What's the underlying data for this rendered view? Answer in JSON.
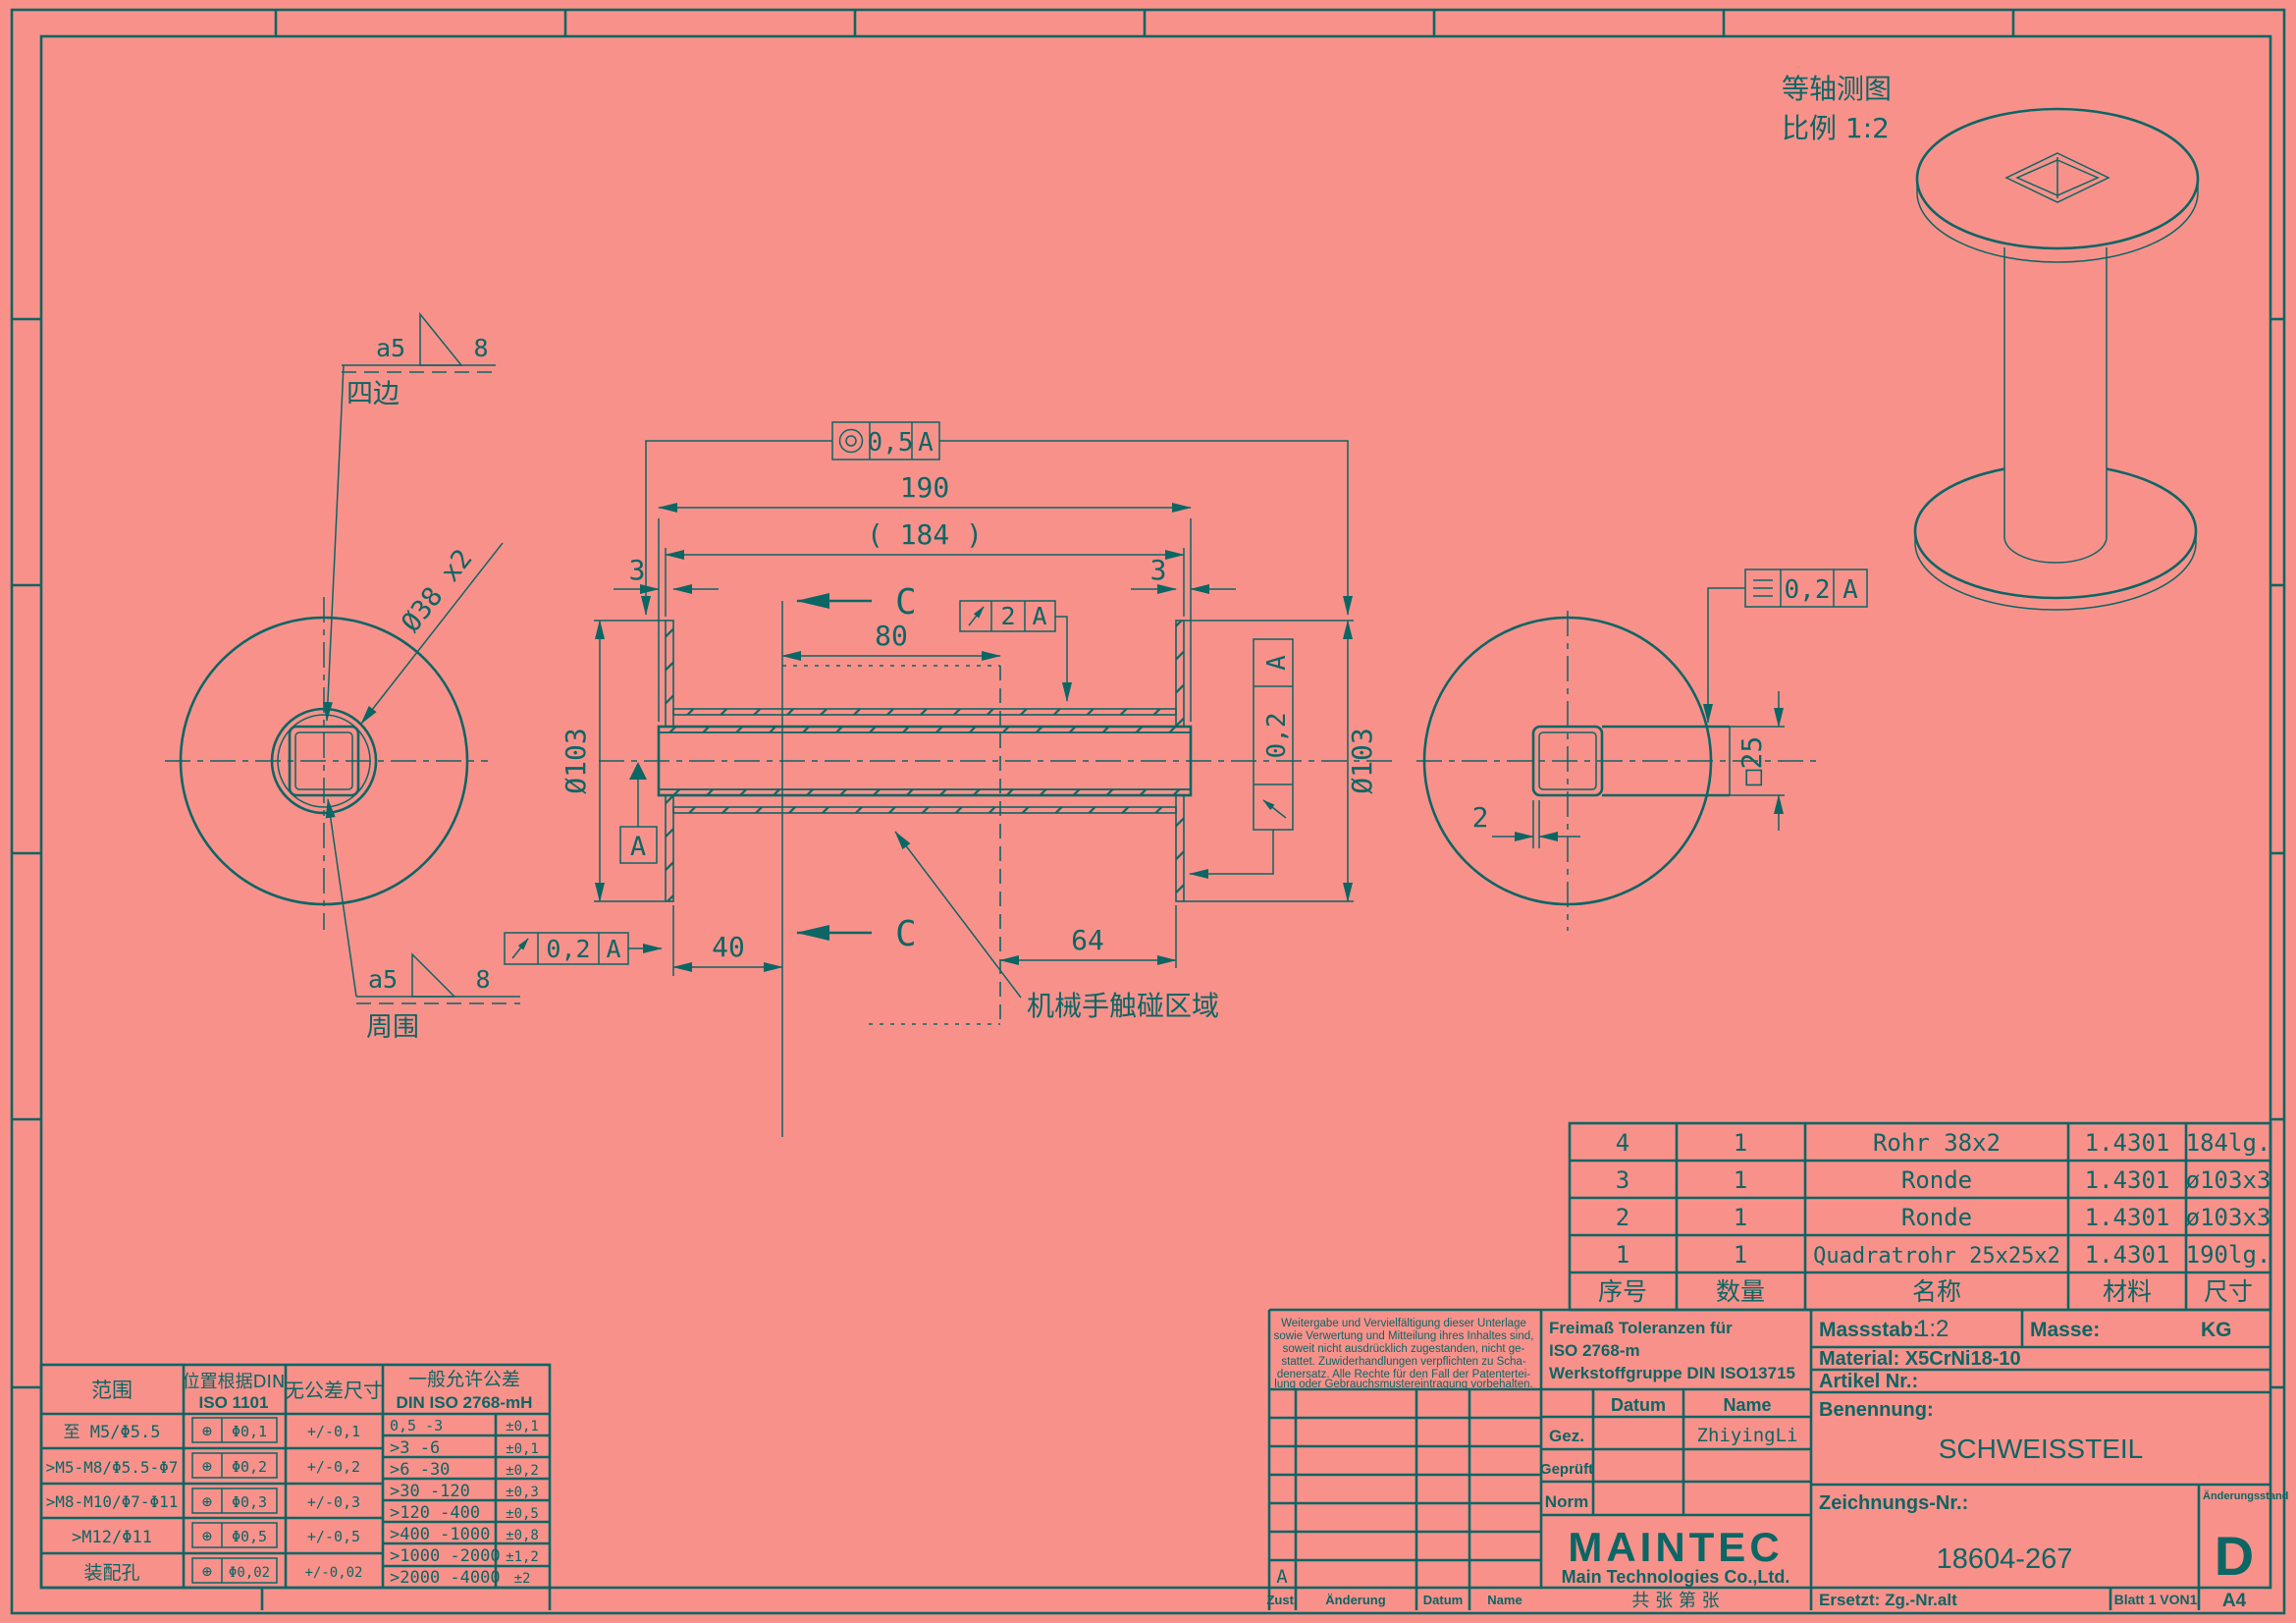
{
  "colors": {
    "background": "#f9918b",
    "ink": "#0b6664"
  },
  "iso": {
    "caption_line1": "等轴测图",
    "caption_line2": "比例 1:2"
  },
  "left_view": {
    "weld_top_size": "a5",
    "weld_top_len": "8",
    "weld_top_note": "四边",
    "weld_bot_size": "a5",
    "weld_bot_len": "8",
    "weld_bot_note": "周围",
    "tube_label": "Ø38 x2"
  },
  "main_view": {
    "d190": "190",
    "d184": "( 184 )",
    "d3_left": "3",
    "d3_right": "3",
    "d80": "80",
    "d40": "40",
    "d64": "64",
    "dia_left": "Ø103",
    "dia_right": "Ø103",
    "section_top": "C",
    "section_bottom": "C",
    "datum": "A",
    "touch_note": "机械手触碰区域",
    "fcf_conc": {
      "val": "0,5",
      "ref": "A"
    },
    "fcf_runout2": {
      "val": "2",
      "ref": "A"
    },
    "fcf_runout_bl": {
      "val": "0,2",
      "ref": "A"
    },
    "fcf_runout_r": {
      "val": "0,2",
      "ref": "A"
    }
  },
  "right_view": {
    "fcf_sym": {
      "val": "0,2",
      "ref": "A"
    },
    "wall": "2",
    "square": "□25"
  },
  "parts_table": {
    "headers": [
      "序号",
      "数量",
      "名称",
      "材料",
      "尺寸"
    ],
    "rows": [
      [
        "4",
        "1",
        "Rohr 38x2",
        "1.4301",
        "184lg."
      ],
      [
        "3",
        "1",
        "Ronde",
        "1.4301",
        "ø103x3"
      ],
      [
        "2",
        "1",
        "Ronde",
        "1.4301",
        "ø103x3"
      ],
      [
        "1",
        "1",
        "Quadratrohr 25x25x2",
        "1.4301",
        "190lg."
      ]
    ]
  },
  "tol_table": {
    "h_range": "范围",
    "h_pos1": "位置根据DIN",
    "h_pos2": "ISO 1101",
    "h_free": "无公差尺寸",
    "h_gen1": "一般允许公差",
    "h_gen2": "DIN ISO 2768-mH",
    "pos_sym": "⊕",
    "rows": [
      {
        "range": "至  M5/Φ5.5",
        "pos": "Φ0,1",
        "tol": "+/-0,1"
      },
      {
        "range": ">M5-M8/Φ5.5-Φ7",
        "pos": "Φ0,2",
        "tol": "+/-0,2"
      },
      {
        "range": ">M8-M10/Φ7-Φ11",
        "pos": "Φ0,3",
        "tol": "+/-0,3"
      },
      {
        "range": ">M12/Φ11",
        "pos": "Φ0,5",
        "tol": "+/-0,5"
      },
      {
        "range": "装配孔",
        "pos": "Φ0,02",
        "tol": "+/-0,02"
      }
    ],
    "gen_rows": [
      [
        "0,5 -3",
        "±0,1"
      ],
      [
        ">3 -6",
        "±0,1"
      ],
      [
        ">6 -30",
        "±0,2"
      ],
      [
        ">30 -120",
        "±0,3"
      ],
      [
        ">120 -400",
        "±0,5"
      ],
      [
        ">400 -1000",
        "±0,8"
      ],
      [
        ">1000 -2000",
        "±1,2"
      ],
      [
        ">2000 -4000",
        "±2"
      ]
    ]
  },
  "notice": {
    "lines": [
      "Weitergabe und Vervielfältigung dieser Unterlage",
      "sowie Verwertung und Mitteilung ihres Inhaltes sind,",
      "soweit nicht ausdrücklich zugestanden, nicht ge-",
      "stattet. Zuwiderhandlungen verpflichten zu Scha-",
      "denersatz. Alle Rechte für den Fall der Patentertei-",
      "lung oder Gebrauchsmustereintragung vorbehalten."
    ]
  },
  "freimass": {
    "lines": [
      "Freimaß Toleranzen für",
      "ISO 2768-m",
      "Werkstoffgruppe DIN ISO13715"
    ]
  },
  "sig": {
    "datum": "Datum",
    "name": "Name",
    "gez": "Gez.",
    "gez_name": "ZhiyingLi",
    "geprueft": "Geprüft",
    "norm": "Norm"
  },
  "company": {
    "logo": "MAINTEC",
    "sub": "Main Technologies Co.,Ltd.",
    "sheets": "共 张 第 张"
  },
  "title": {
    "massstab_label": "Massstab:",
    "massstab": "1:2",
    "masse_label": "Masse:",
    "masse_unit": "KG",
    "material": "Material: X5CrNi18-10",
    "artikel": "Artikel Nr.:",
    "benennung_label": "Benennung:",
    "benennung": "SCHWEISSTEIL",
    "zeichnung_label": "Zeichnungs-Nr.:",
    "zeichnung": "18604-267",
    "aend_label": "Änderungsstand",
    "rev": "D",
    "ersetzt": "Ersetzt: Zg.-Nr.alt",
    "blatt": "Blatt 1 VON1",
    "format": "A4"
  },
  "rev_table": {
    "zust": "Zust.",
    "aenderung": "Änderung",
    "datum": "Datum",
    "name": "Name",
    "rev_a": "A"
  }
}
